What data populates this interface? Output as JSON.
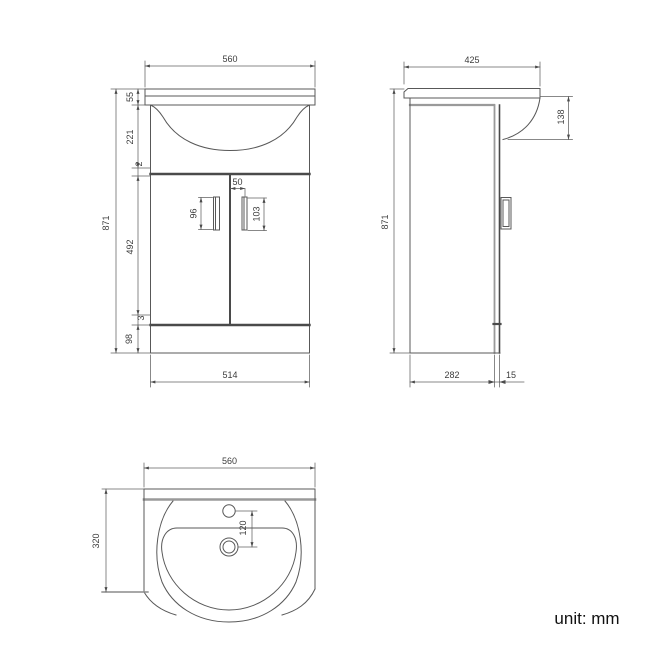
{
  "footer": {
    "unit_label": "unit: mm"
  },
  "colors": {
    "background": "#ffffff",
    "line": "#585858",
    "dark_line": "#4a4a4a",
    "gray_line": "#9a9a9a",
    "text": "#3c3c3c"
  },
  "views": {
    "front": {
      "overall_width": "560",
      "rim_height": "55",
      "basin_height": "221",
      "top_gap": "2",
      "overall_height": "871",
      "door_height": "492",
      "bottom_gap": "3",
      "plinth_height": "98",
      "cabinet_width": "514",
      "handle_offset": "50",
      "left_handle_length": "96",
      "right_handle_length": "103"
    },
    "side": {
      "overall_depth": "425",
      "basin_overhang": "138",
      "overall_height": "871",
      "cabinet_depth": "282",
      "door_thickness": "15"
    },
    "plan": {
      "overall_width": "560",
      "overall_depth": "320",
      "tap_to_drain": "120"
    }
  }
}
